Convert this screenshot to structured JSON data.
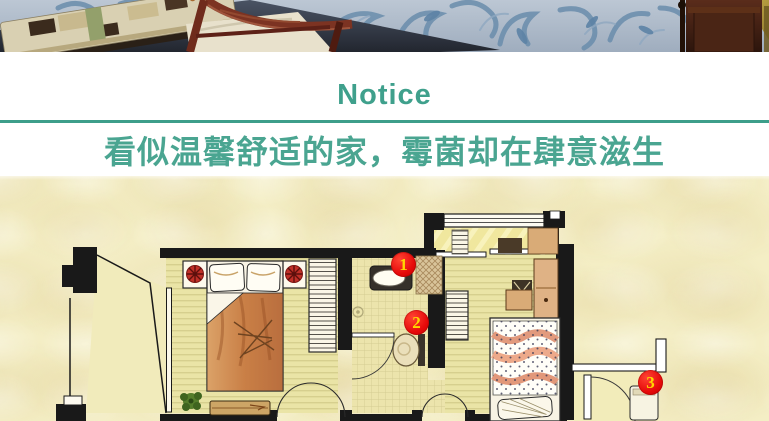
{
  "notice": {
    "title": "Notice",
    "subtitle": "看似温馨舒适的家，霉菌却在肆意滋生"
  },
  "floor_plan": {
    "markers": [
      {
        "number": "1"
      },
      {
        "number": "2"
      },
      {
        "number": "3"
      }
    ]
  },
  "colors": {
    "accent_teal": "#3FA08C",
    "subtitle_teal": "#4AA591",
    "marker_red": "#E60A0A",
    "marker_number_yellow": "#FFD700",
    "plan_background_cream": "#F4EEC5"
  }
}
